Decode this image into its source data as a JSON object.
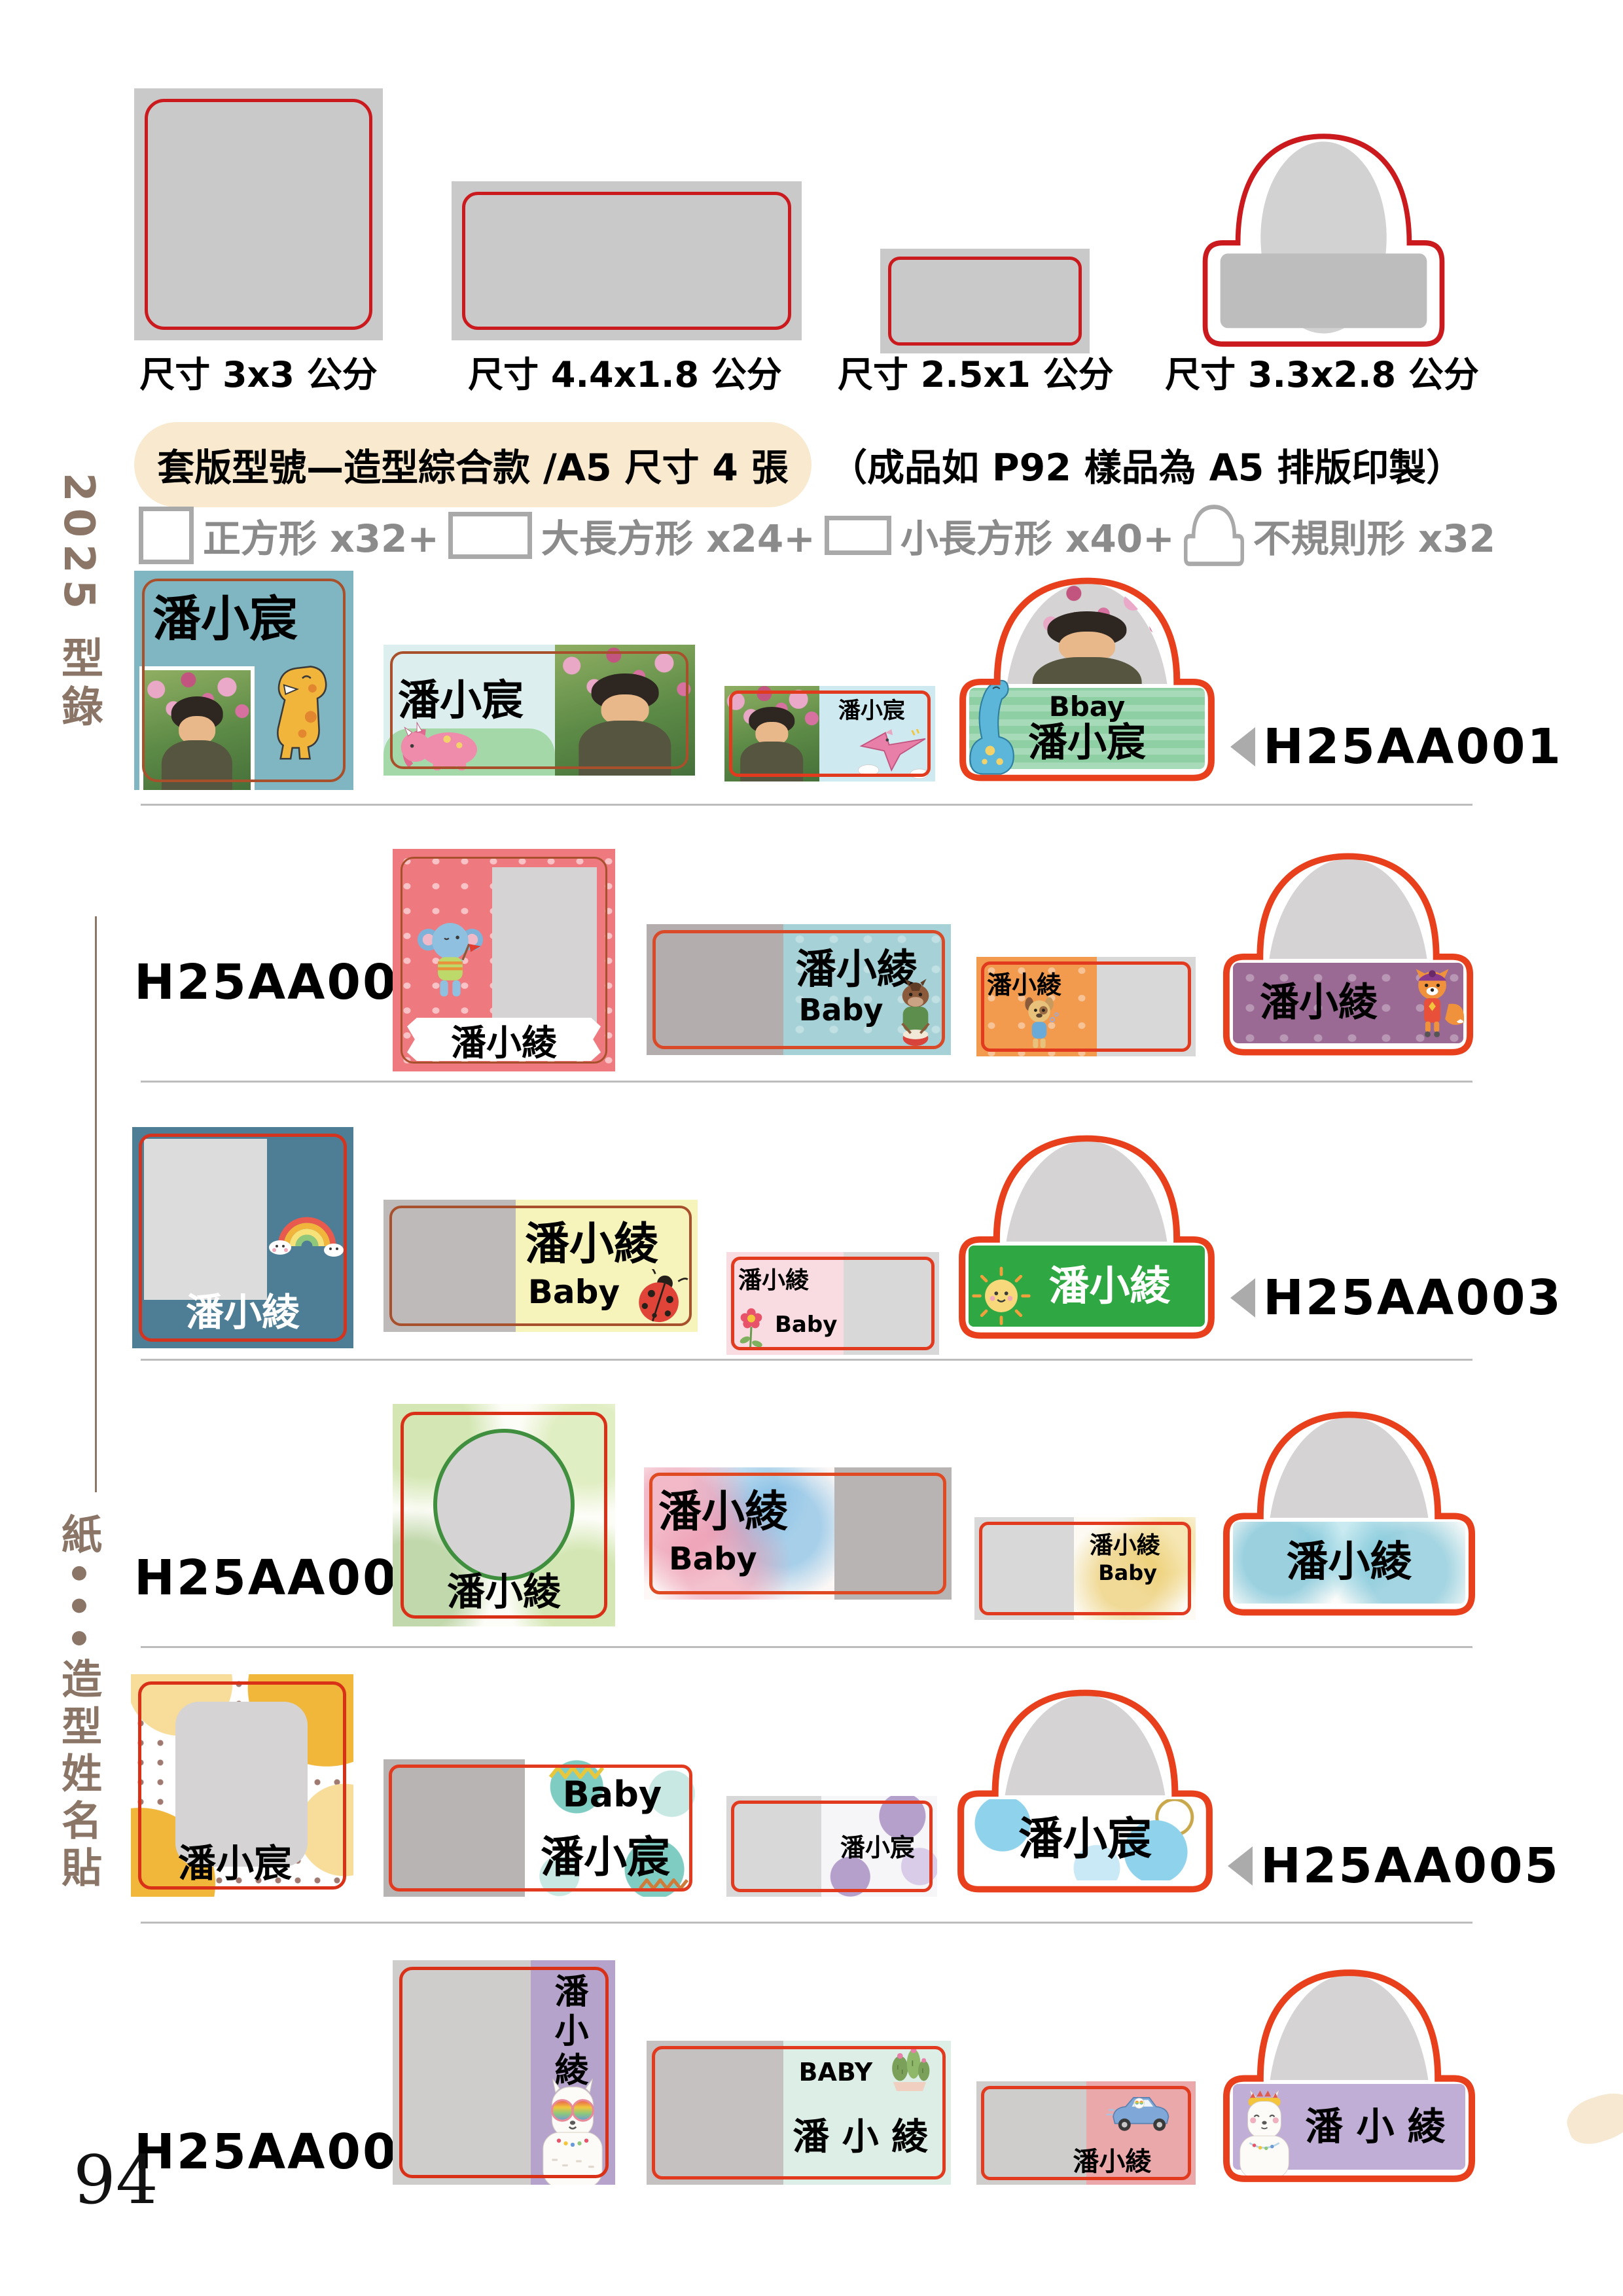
{
  "page_number": "94",
  "sidebar": {
    "top": "2025 型錄",
    "bottom": "紙•••造型姓名貼"
  },
  "size_templates": [
    {
      "shape": "square",
      "label": "尺寸 3x3 公分"
    },
    {
      "shape": "large-rect",
      "label": "尺寸 4.4x1.8 公分"
    },
    {
      "shape": "small-rect",
      "label": "尺寸 2.5x1 公分"
    },
    {
      "shape": "irregular",
      "label": "尺寸 3.3x2.8 公分"
    }
  ],
  "header": {
    "pill": "套版型號—造型綜合款 /A5 尺寸 4 張",
    "note": "（成品如 P92 樣品為 A5 排版印製）"
  },
  "sheet_counts": [
    {
      "shape": "square",
      "label": "正方形 x32+"
    },
    {
      "shape": "large-rect",
      "label": "大長方形 x24+"
    },
    {
      "shape": "small-rect",
      "label": "小長方形 x40+"
    },
    {
      "shape": "irregular",
      "label": "不規則形 x32"
    }
  ],
  "colors": {
    "template_border": "#cb1a1e",
    "sticker_border_red": "#e13a1e",
    "sticker_border_brown": "#a8502c",
    "header_beige": "#f8e9cf",
    "sidebar_brown": "#8a7566",
    "divider_gray": "#bcbcbc",
    "placeholder_gray": "#d5d3d3"
  },
  "rows": [
    {
      "code": "H25AA001",
      "arrow_side": "right",
      "square": {
        "name": "潘小宸",
        "bg": "#7fb6c1"
      },
      "large": {
        "name": "潘小宸",
        "bg": "#dcefee"
      },
      "small": {
        "name": "潘小宸",
        "bg": "#cfe9f0"
      },
      "irregular": {
        "sub": "Bbay",
        "name": "潘小宸",
        "band_bg": "#8ecfa4"
      }
    },
    {
      "code": "H25AA002",
      "arrow_side": "left",
      "square": {
        "name": "潘小綾",
        "bg": "#ee7a80"
      },
      "large": {
        "name": "潘小綾",
        "sub": "Baby",
        "bg": "#a6d2d7"
      },
      "small": {
        "name": "潘小綾",
        "bg": "#f29a4e"
      },
      "irregular": {
        "name": "潘小綾",
        "band_bg": "#9a6a94"
      }
    },
    {
      "code": "H25AA003",
      "arrow_side": "right",
      "square": {
        "name": "潘小綾",
        "bg": "#4e7d96"
      },
      "large": {
        "name": "潘小綾",
        "sub": "Baby",
        "bg": "#f6f3bb"
      },
      "small": {
        "name": "潘小綾",
        "sub": "Baby",
        "bg": "#f8dce1"
      },
      "irregular": {
        "name": "潘小綾",
        "band_bg": "#2fa844"
      }
    },
    {
      "code": "H25AA004",
      "arrow_side": "left",
      "square": {
        "name": "潘小綾",
        "bg": "#fdfdf8"
      },
      "large": {
        "name": "潘小綾",
        "sub": "Baby",
        "bg": "#fdf8f6"
      },
      "small": {
        "name": "潘小綾",
        "sub": "Baby",
        "bg": "#fcfaf2"
      },
      "irregular": {
        "name": "潘小綾",
        "band_bg": "#fcfcfa"
      }
    },
    {
      "code": "H25AA005",
      "arrow_side": "right",
      "square": {
        "name": "潘小宸",
        "bg": "#ffffff"
      },
      "large": {
        "sub": "Baby",
        "name": "潘小宸",
        "bg": "#ffffff"
      },
      "small": {
        "name": "潘小宸",
        "bg": "#f6f5f8"
      },
      "irregular": {
        "name": "潘小宸",
        "band_bg": "#ffffff"
      }
    },
    {
      "code": "H25AA006",
      "arrow_side": "left",
      "square": {
        "name": "潘小綾",
        "bg": "#b5a3cb"
      },
      "large": {
        "sub": "BABY",
        "name": "潘 小 綾",
        "bg": "#dceee6"
      },
      "small": {
        "name": "潘小綾",
        "bg": "#eba8ab"
      },
      "irregular": {
        "name": "潘 小 綾",
        "band_bg": "#c0aed7"
      }
    }
  ]
}
